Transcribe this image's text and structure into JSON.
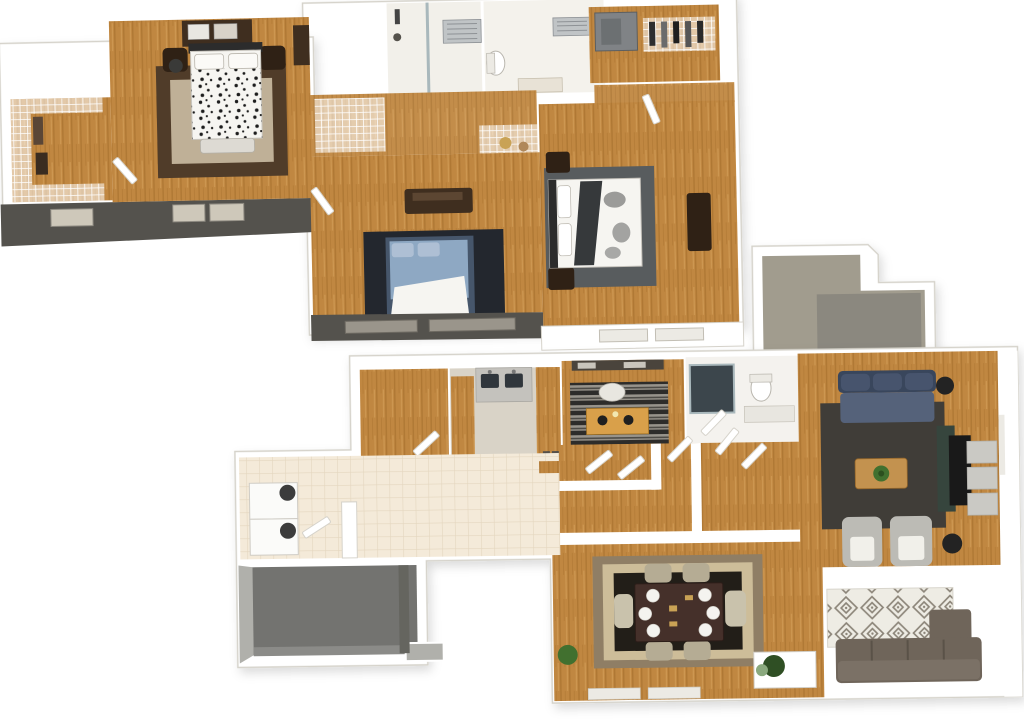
{
  "scene": {
    "description": "Isometric 3D rendering of a two-story residential floor plan with no text labels",
    "floors": [
      {
        "name": "upper-floor",
        "position": "top-left",
        "rooms": [
          "walk-in-closet-west",
          "master-bedroom",
          "bathroom-1",
          "bathroom-2",
          "walk-in-closet-east",
          "hallway",
          "bedroom-2",
          "bedroom-3"
        ]
      },
      {
        "name": "lower-floor",
        "position": "bottom-right",
        "rooms": [
          "patio-entry",
          "den",
          "kitchen",
          "office",
          "bathroom",
          "hallway",
          "living-room",
          "dining-room",
          "laundry-entry",
          "garage",
          "sitting-area"
        ]
      }
    ]
  },
  "palette": {
    "page_bg": "#ffffff",
    "wall": "#ffffff",
    "wall_shade": "#eceae4",
    "wall_edge": "#d6d3cb",
    "exterior_dark": "#54524d",
    "window_lite": "#cec8ba",
    "wood": "#c08741",
    "wood_streak": "#a06c29",
    "tile": "#f4ead9",
    "tile_line": "#e4d6bf",
    "kitchen_floor": "#d9d3c7",
    "counter_grey": "#c4c2bd",
    "sink_dark": "#30363c",
    "garage_floor": "#737370",
    "garage_apron": "#b0b0ab",
    "patio": "#a19c8e",
    "patio_inset": "#8b887f",
    "rug_master_border": "#503c29",
    "rug_master_center": "#bfb097",
    "furn_dark": "#3f2e1f",
    "furn_espresso": "#2f2115",
    "duvet": "#f6f5f1",
    "rug_navy": "#23272e",
    "bed_blue": "#8ea8c3",
    "bed_blue_dark": "#46566b",
    "rug_grey": "#585c5e",
    "blanket_dark": "#36393b",
    "sofa_navy": "#47546d",
    "sofa_navy_dark": "#39465c",
    "rug_charcoal": "#403d38",
    "table_wood": "#c3924f",
    "plant_green": "#41702f",
    "chair_grey": "#bcbbb5",
    "cushion_white": "#f1f0ea",
    "tv_black": "#191919",
    "console_green": "#36453d",
    "bench_grey": "#cac9c4",
    "dining_rug_outer": "#8f7e65",
    "dining_rug_mid": "#cdbd99",
    "dining_rug_black": "#221e18",
    "dining_table": "#45302a",
    "dining_chair": "#b5ac94",
    "sectional": "#6f655a",
    "pattern_rug_bg": "#eeece4",
    "pattern_rug_line": "#8c8579",
    "desk_orange": "#d9a04a",
    "stripe_dark": "#2d2c2a",
    "stripe_light": "#97938b",
    "appliance_white": "#fbfbf9",
    "appliance_dark": "#3c3c3c",
    "shower_dark": "#3c464c",
    "shower_glass": "#a9b8bc",
    "grate_grey": "#c0c4c6",
    "safe_grey": "#808386",
    "spot_black": "#1d1d1d"
  }
}
